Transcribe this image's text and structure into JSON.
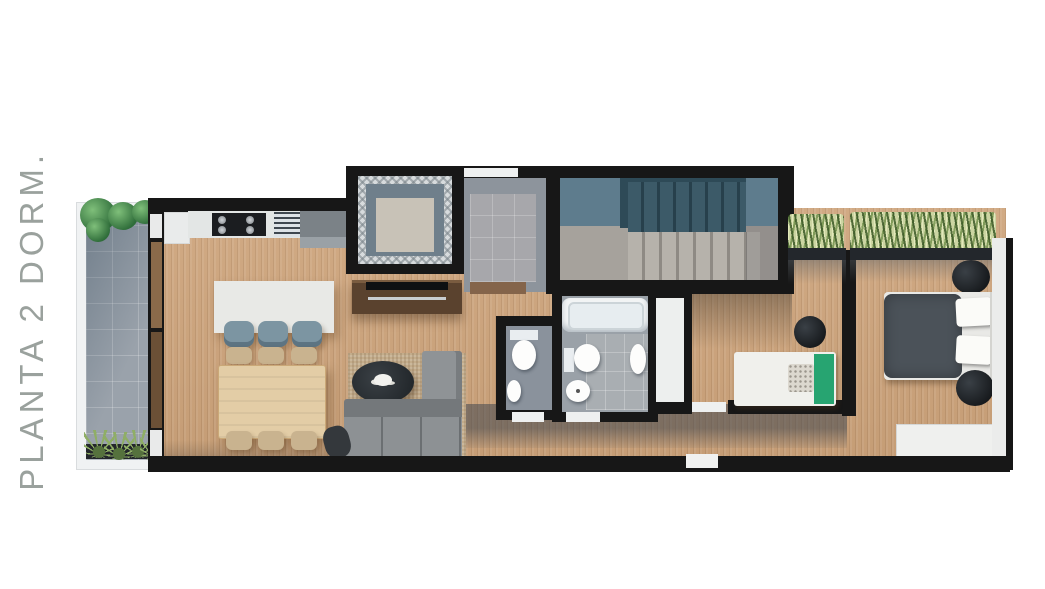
{
  "title": {
    "text": "PLANTA 2 DORM."
  },
  "palette": {
    "background": "#ffffff",
    "title_gray": "#9aa19d",
    "wall": "#171717",
    "wood_floor": "#cda37a",
    "terrace_tile": "#9aa2ab",
    "stair_wall_blue": "#5e7c8d",
    "stair_void_blue": "#2e4a57",
    "bath_tile": "#9aa1a8",
    "entry_tile": "#a7a7ab",
    "island_white": "#e8e9e6",
    "counter_white": "#e3e6e5",
    "cabinet_gray": "#7b8287",
    "sofa_gray": "#8d9194",
    "rug_tan": "#c3ac8b",
    "table_wood": "#e3cda6",
    "chair_tan": "#c9b38f",
    "stool_blue": "#7c95a2",
    "tv_unit_walnut": "#5a422e",
    "bed_duvet_gray": "#4b5259",
    "accent_green_blanket": "#27a471",
    "plant_green": "#2f6d3a",
    "grass_green": "#8fae66",
    "fixture_white": "#f2f4f5"
  }
}
